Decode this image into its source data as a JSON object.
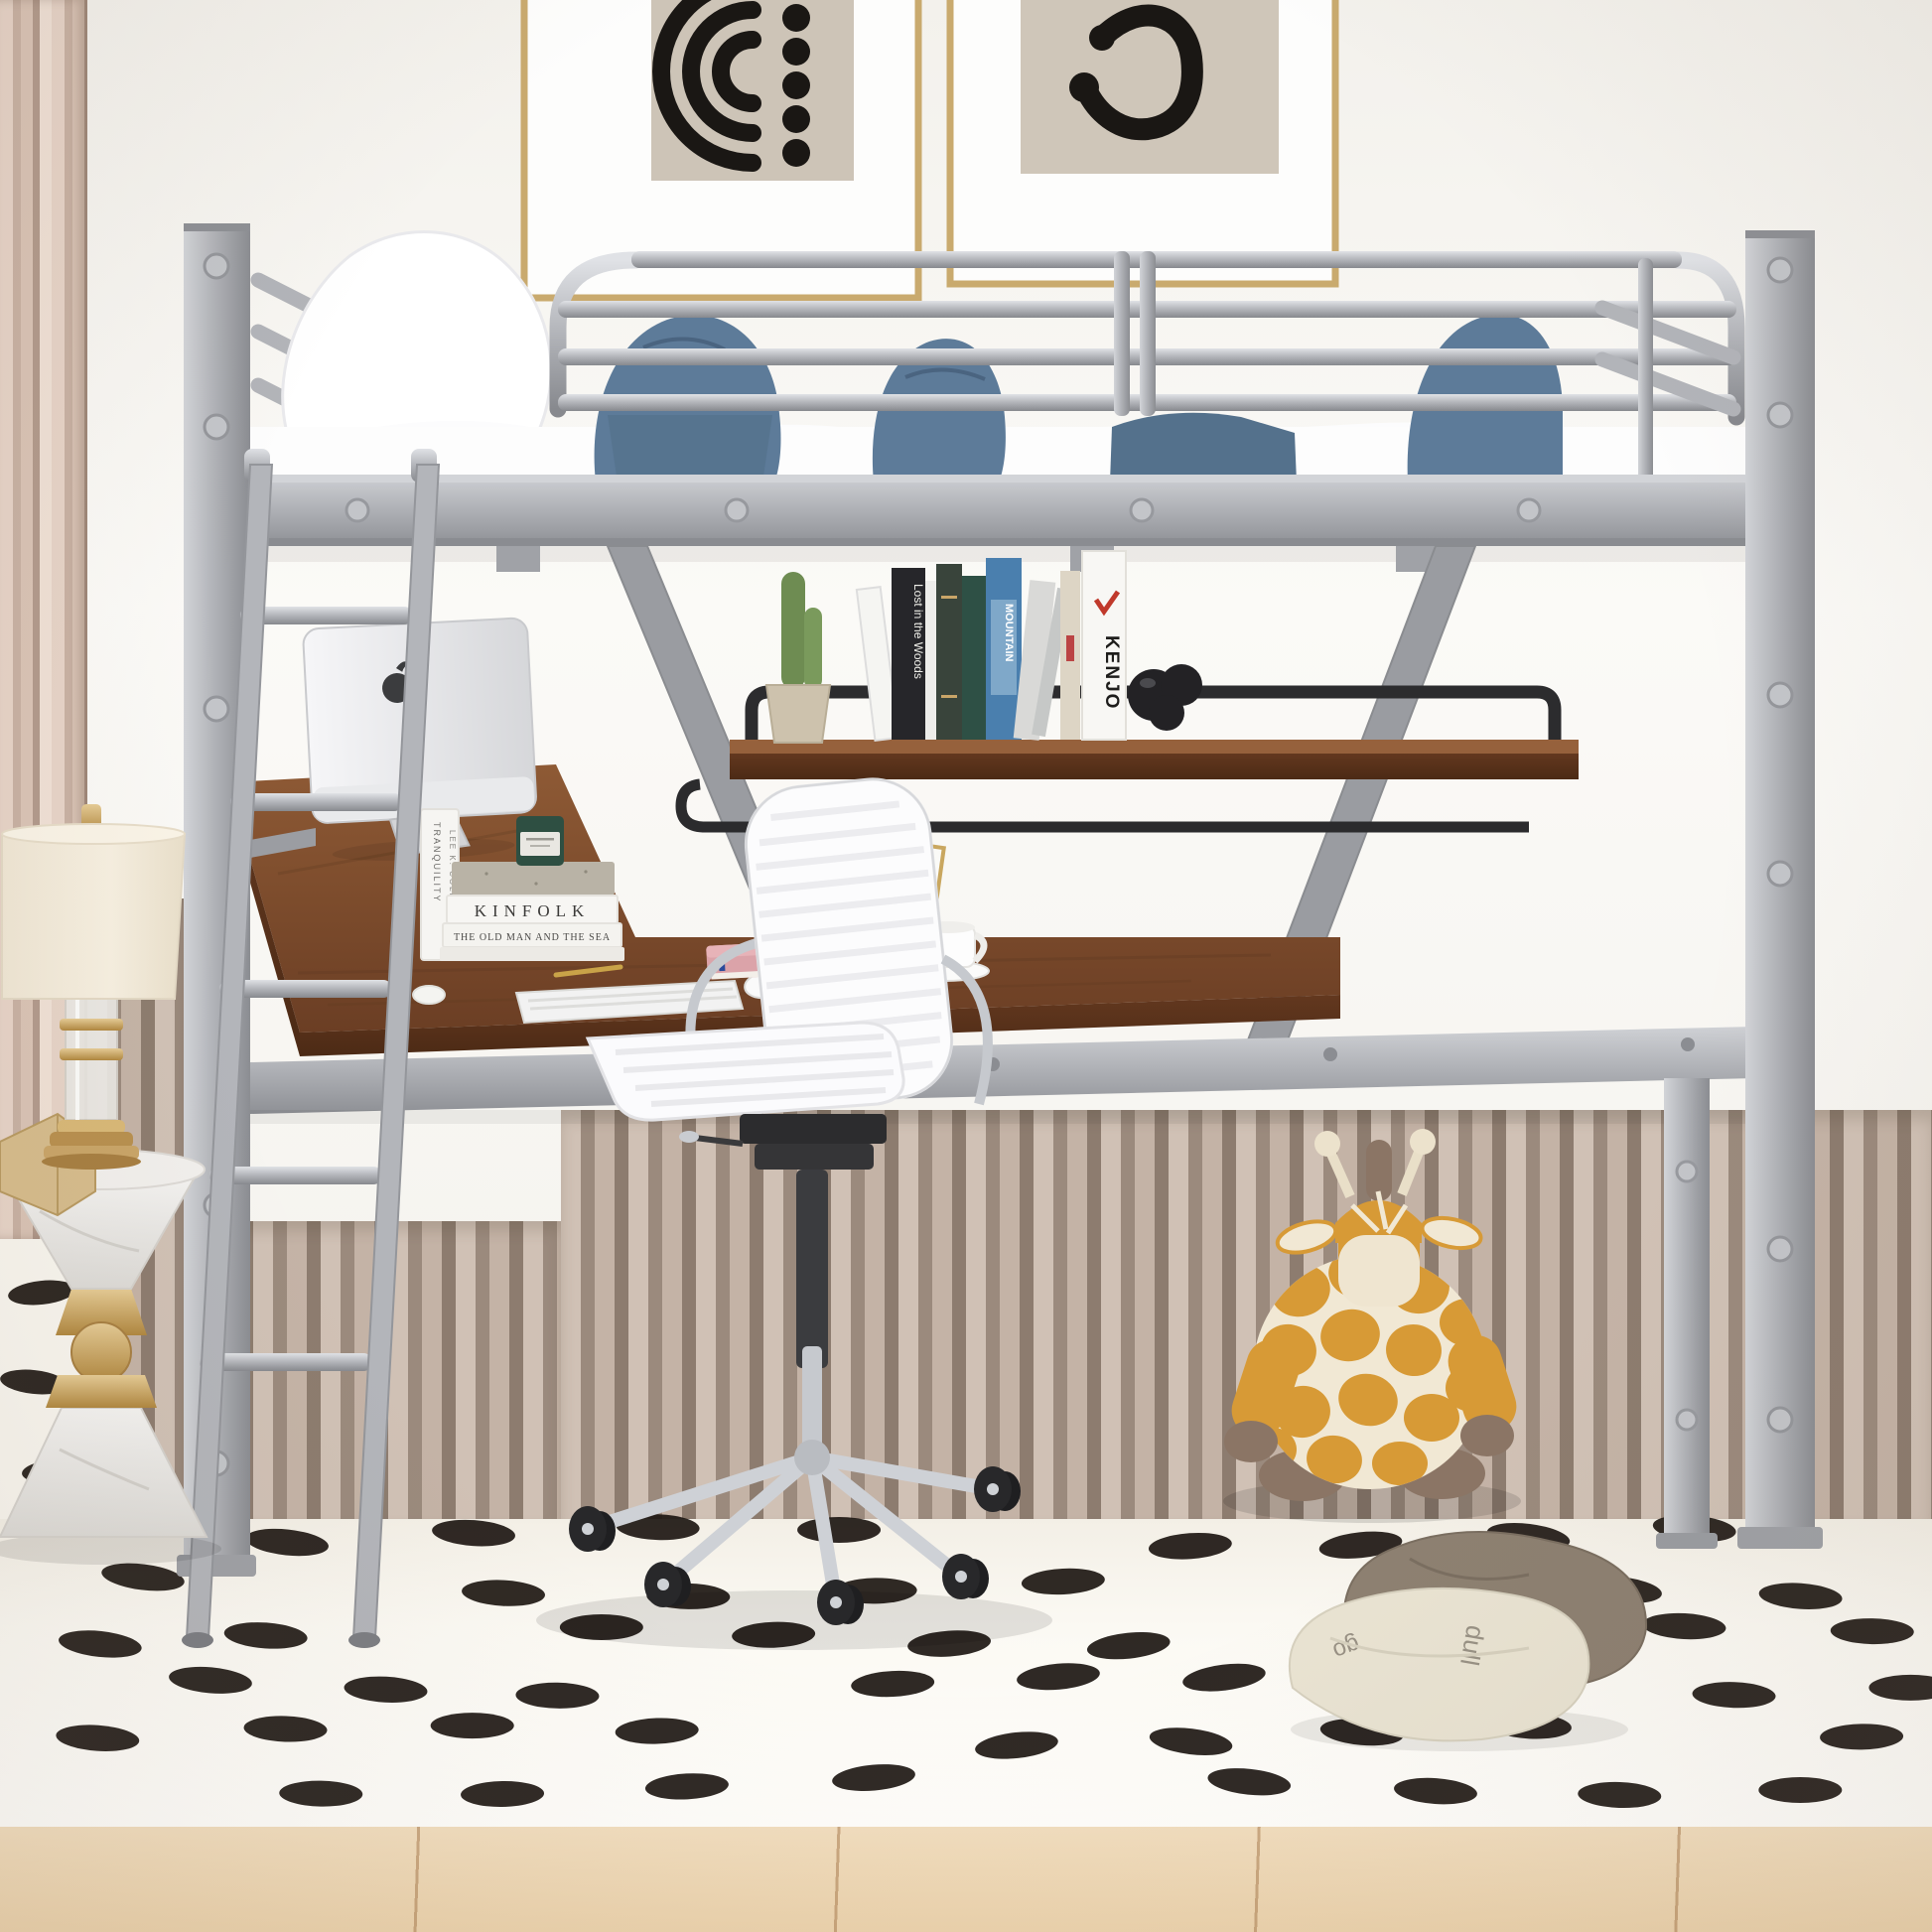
{
  "title": "Silver metal loft bed with L-shaped desk, shelf and white office chair in kids room",
  "palette": {
    "wall": "#f7f5f0",
    "wainscot_light": "#d0c1b5",
    "wainscot_dark": "#8d7c6f",
    "curtain": "#d9c3b5",
    "metal_frame": "#b4b6bb",
    "wood_desk": "#7a4a2e",
    "shelf_rail_black": "#2c2c2e",
    "bedding_blue": "#5d7b99",
    "bedding_white": "#ffffff",
    "chair_white": "#fcfcfd",
    "chrome": "#c6c9ce",
    "giraffe_orange": "#d79a36",
    "giraffe_cream": "#f1e8d4",
    "giraffe_brown": "#8b7565",
    "rug": "#f8f5ee",
    "rug_mark": "#1d1712",
    "floor_wood": "#efd9b6",
    "gold_accent": "#c9a568",
    "poster_paper": "#cdc4b7",
    "poster_ink": "#1a1714",
    "candle_green": "#2e4f42",
    "book_pink": "#dba3a9"
  },
  "posters": {
    "left_motif": "concentric-arcs-with-dots",
    "right_motif": "curved-hook-with-dots"
  },
  "books": {
    "lost_in_the_woods": "Lost in the Woods",
    "mountain": "MOUNTAIN",
    "kenjo": "KENJO",
    "tranquility": "TRANQUILITY",
    "author": "LEE K. COLE",
    "kinfolk": "KINFOLK",
    "old_man_sea": "THE OLD MAN AND THE SEA"
  },
  "pillow": {
    "text_top": "go",
    "text_side": "dull"
  },
  "objects": [
    "loft-bed-silver-metal",
    "ladder",
    "guardrail",
    "white-pillow",
    "blue-bedding",
    "wall-shelf-wood",
    "cactus-plant",
    "book-row",
    "black-knot-sculpture",
    "l-shaped-desk",
    "imac-computer",
    "keyboard",
    "mouse",
    "book-stack",
    "green-candle",
    "pen-cup-gold-pencils",
    "gold-scissors",
    "desk-calendar",
    "gold-frame",
    "coffee-cup",
    "pink-book",
    "white-office-chair",
    "giraffe-plush",
    "floor-pillows",
    "table-lamp",
    "marble-side-table",
    "gold-hexagon-box",
    "polka-dash-rug",
    "framed-posters"
  ]
}
